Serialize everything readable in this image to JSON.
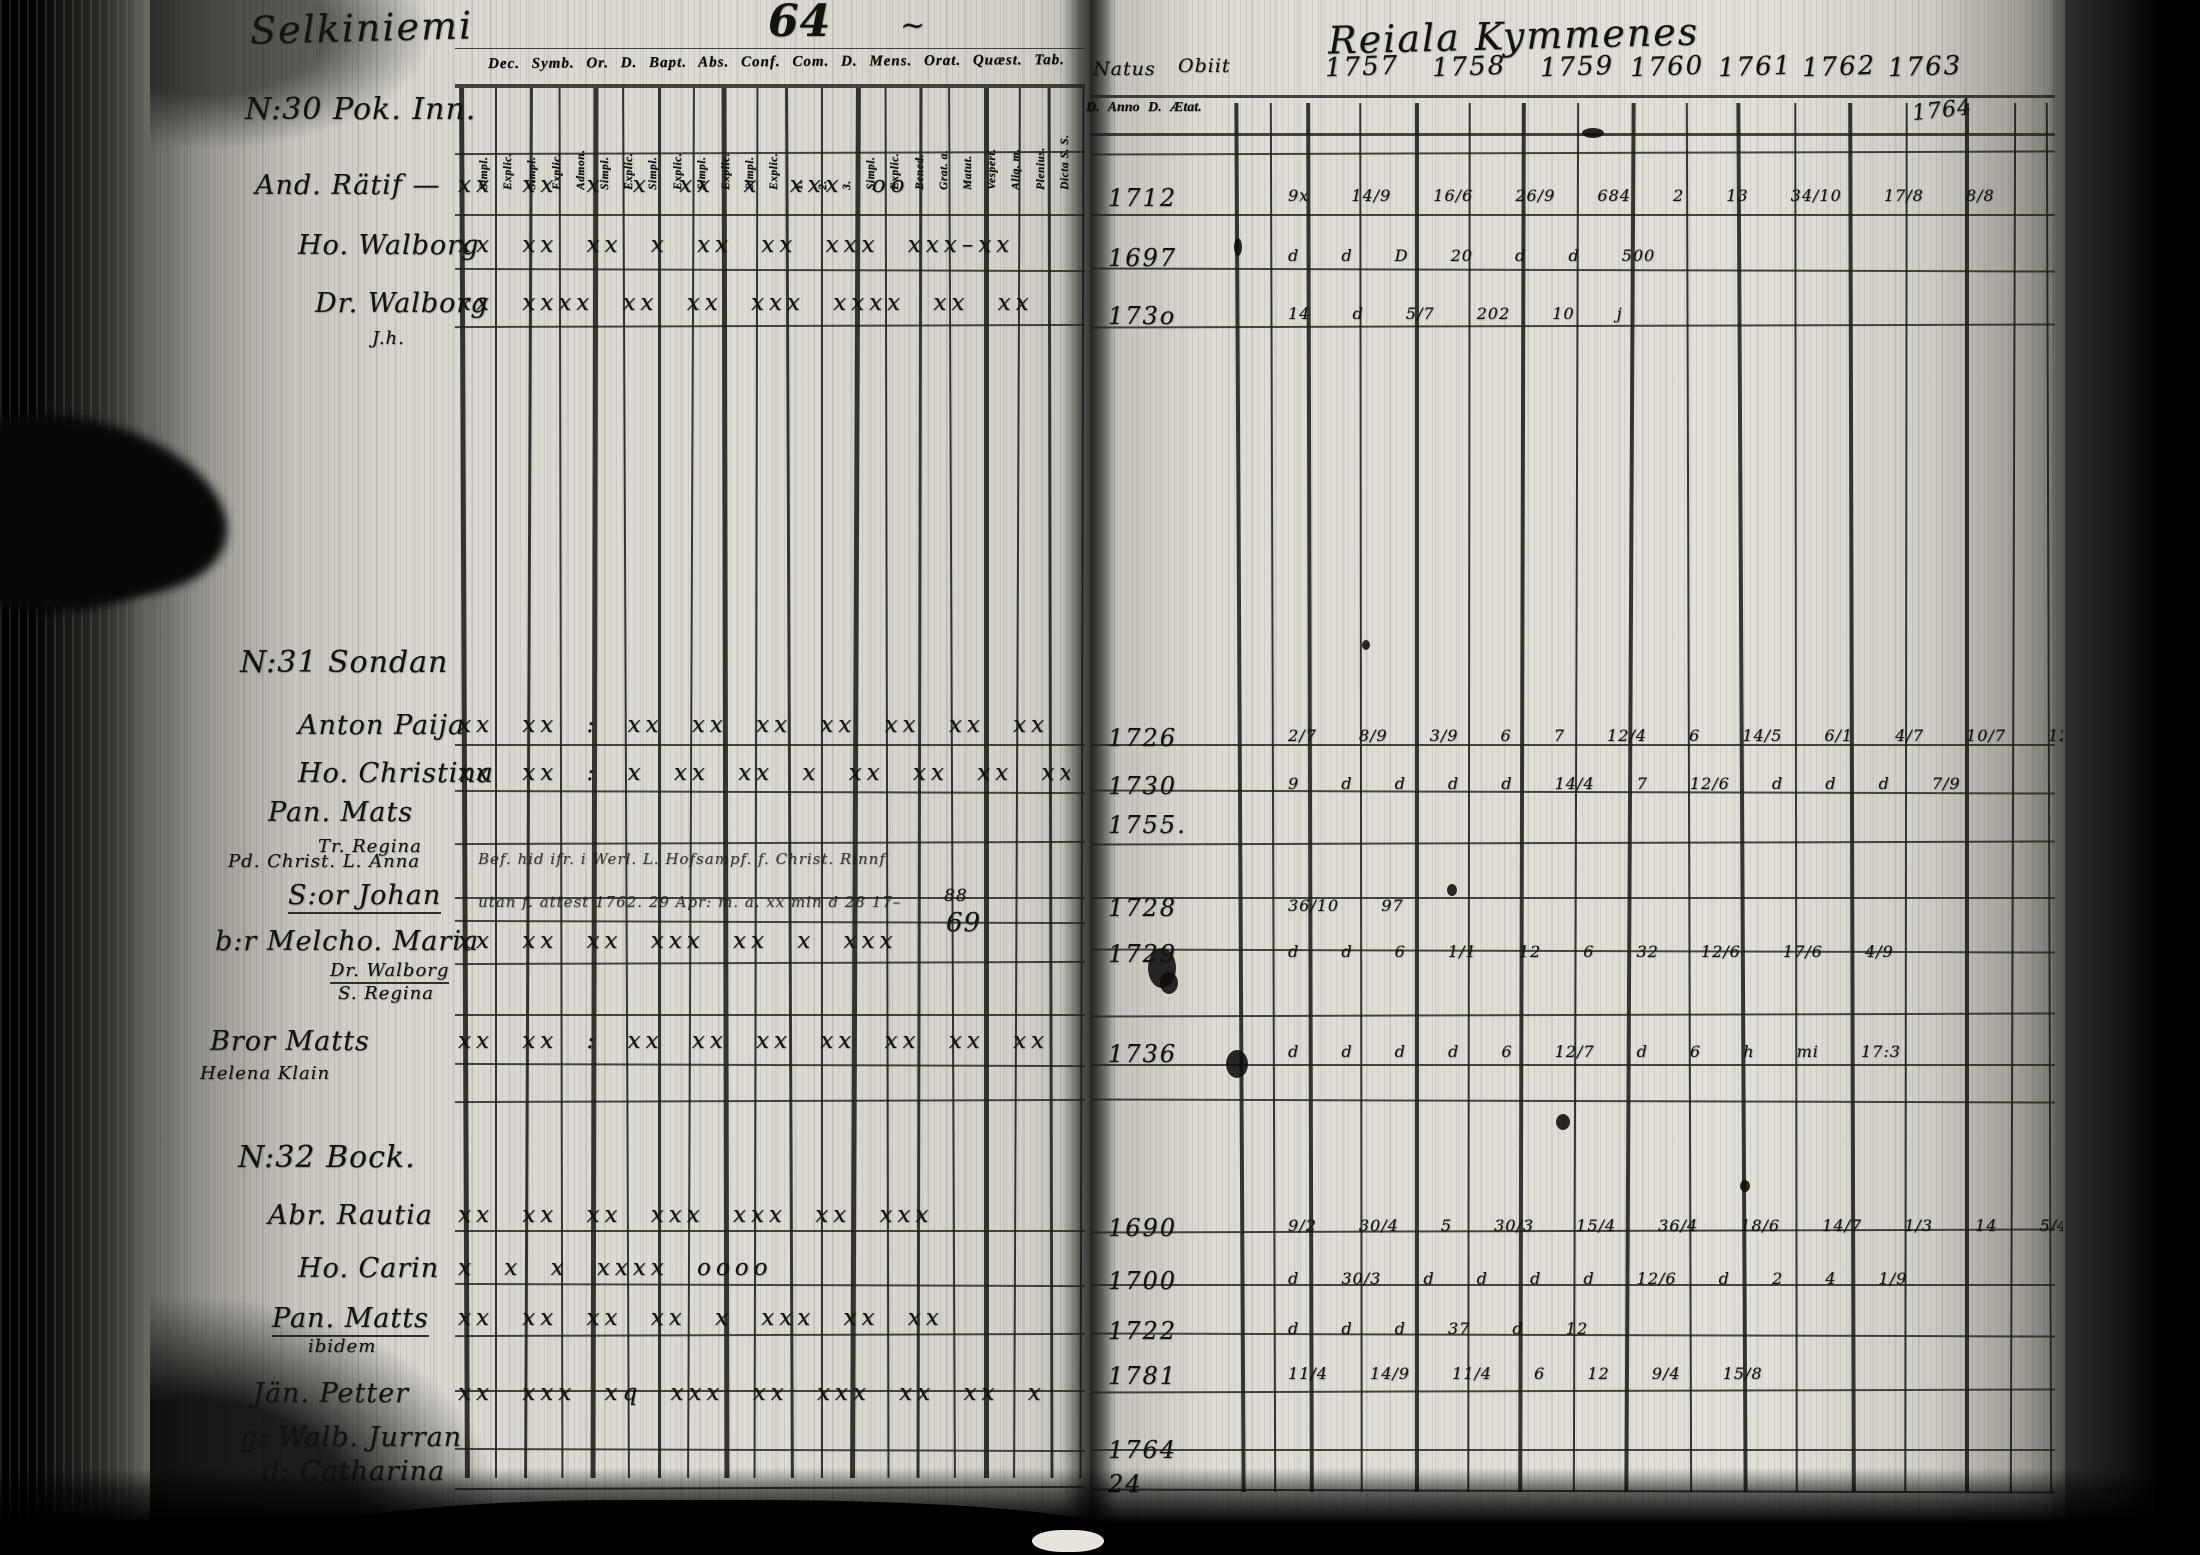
{
  "scan": {
    "left_page_title": "Selkiniemi",
    "page_number": "64",
    "tilde_mark": "~",
    "right_page_title": "Reiala Kymmenes",
    "left_header": {
      "printed_row": "Dec. Symb. Or. D. Bapt. Abs. Conf. Com. D. Mens. Orat. Quæst. Tab.",
      "column_labels": [
        "Simpl.",
        "Explic.",
        "Simpl.",
        "Explic.",
        "Admon.",
        "Simpl.",
        "Explic.",
        "Simpl.",
        "Explic.",
        "Simpl.",
        "Explic.",
        "Simpl.",
        "Explic.",
        "1.",
        "2.",
        "3.",
        "Simpl.",
        "Explic.",
        "Bened.",
        "Grat. a.",
        "Matut.",
        "Vespert.",
        "Aliq. m.",
        "Plenius.",
        "Dicta S. S."
      ]
    },
    "right_header": {
      "natus": "Natus",
      "obiit": "Obiit",
      "years": [
        "1757",
        "1758",
        "1759",
        "1760",
        "1761",
        "1762",
        "1763"
      ],
      "sub_row": "D. Anno D. Ætat.",
      "added_year": "1764"
    },
    "notes": {
      "line1": "Bef. hid ifr. i Werl. L. Hofsampf. f. Christ. Rinnf",
      "line2": "utan f. attest 1762. 29 Apr: m. a. xx min d 28 17–",
      "mark88": "88",
      "mark69": "69"
    },
    "groups": [
      {
        "heading": "N:30 Pok. Inn.",
        "hx": 245,
        "hy": 92,
        "rows": [
          {
            "name": "And. Rätif —",
            "x": 255,
            "y": 170,
            "marks": "xx xx   x    x     xx    x   xxx   oo",
            "natus": "1712",
            "right": "9x  14/9   16/6   26/9   684   2   13   34/10 17/8 8/8"
          },
          {
            "name": "Ho. Walborg",
            "x": 298,
            "y": 230,
            "marks": "xx xx  xx x xx xx xxx  xxx–xx",
            "natus": "1697",
            "right": "d     d      D    20     d         d      500"
          },
          {
            "name": "Dr. Walborg",
            "x": 315,
            "y": 288,
            "marks": "xx xxxx xx xx  xxx  xxxx  xx xx",
            "natus": "173o",
            "right": "14   d     5/7    202     10            j"
          },
          {
            "name": "J.h.",
            "x": 372,
            "y": 328,
            "size": "s"
          }
        ]
      },
      {
        "heading": "N:31 Sondan",
        "hx": 240,
        "hy": 645,
        "rows": [
          {
            "name": "Anton Paija",
            "x": 298,
            "y": 710,
            "marks": "xx xx :  xx xx xx  xx xx  xx  xx",
            "natus": "1726",
            "right": "2/7 8/9 3/9 6 7 12/4 6 14/5   6/1 4/7 10/7 12/9 4/9"
          },
          {
            "name": "Ho. Christina",
            "x": 298,
            "y": 758,
            "marks": "xx xx :  x xx xx x  xx   xx xx  xx",
            "natus": "1730",
            "right": "9  d  d  d  d  14/4 7 12/6   d   d   d  7/9"
          },
          {
            "name": "Pan. Mats",
            "x": 268,
            "y": 797,
            "natus": "1755."
          },
          {
            "name": "Tr. Regina",
            "x": 318,
            "y": 836,
            "size": "s"
          },
          {
            "name": "Pd. Christ. L. Anna",
            "x": 228,
            "y": 851,
            "size": "s"
          },
          {
            "name": "S:or Johan",
            "x": 288,
            "y": 880,
            "ul": true,
            "natus": "1728",
            "right": "36/10   97"
          },
          {
            "name": "b:r Melcho. Maria",
            "x": 215,
            "y": 926,
            "marks": "xx xx   xx xxx xx x  xxx",
            "natus": "1729",
            "right": "d  d  6  1/1  12   6   32   12/6 17/6 4/9"
          },
          {
            "name": "Dr. Walborg",
            "x": 330,
            "y": 960,
            "size": "s",
            "ul": true
          },
          {
            "name": "S. Regina",
            "x": 338,
            "y": 983,
            "size": "s"
          },
          {
            "name": "Bror Matts",
            "x": 210,
            "y": 1026,
            "marks": "xx xx :  xx xx xx  xx xx  xx  xx",
            "natus": "1736",
            "right": "d   d   d   d   6   12/7    d    6 h mi  17:3"
          },
          {
            "name": "Helena Klain",
            "x": 200,
            "y": 1063,
            "size": "s"
          }
        ]
      },
      {
        "heading": "N:32 Bock.",
        "hx": 238,
        "hy": 1140,
        "rows": [
          {
            "name": "Abr. Rautia",
            "x": 268,
            "y": 1200,
            "marks": "xx xx   xx xxx xxx   xx xxx",
            "natus": "1690",
            "right": "9/2 30/4 5 30/3 15/4 36/4 18/6 14/7 1/3   14  5/4   11/9 14/3"
          },
          {
            "name": "Ho. Carin",
            "x": 298,
            "y": 1253,
            "marks": "x     x  x    xxxx   oooo",
            "natus": "1700",
            "right": "d  30/3  d   d   d   d  12/6   d    2  4    1/9"
          },
          {
            "name": "Pan. Matts",
            "x": 272,
            "y": 1303,
            "ul": true,
            "marks": "xx xx  xx xx x xxx  xx xx",
            "natus": "1722",
            "right": "d    d    d    37     d    12"
          },
          {
            "name": "ibidem",
            "x": 308,
            "y": 1336,
            "size": "s"
          },
          {
            "name": "Jän. Petter",
            "x": 253,
            "y": 1378,
            "marks": "xx xxx  xq xxx xx  xxx xx xx x",
            "natus": "1781",
            "ny": 1362,
            "right": "11/4 14/9   11/4   6    12       9/4     15/8"
          },
          {
            "name": "g: Walb. Jurran",
            "x": 240,
            "y": 1422,
            "natus": "1764"
          },
          {
            "name": "d: Catharina",
            "x": 262,
            "y": 1456,
            "natus": "24"
          }
        ]
      }
    ]
  }
}
